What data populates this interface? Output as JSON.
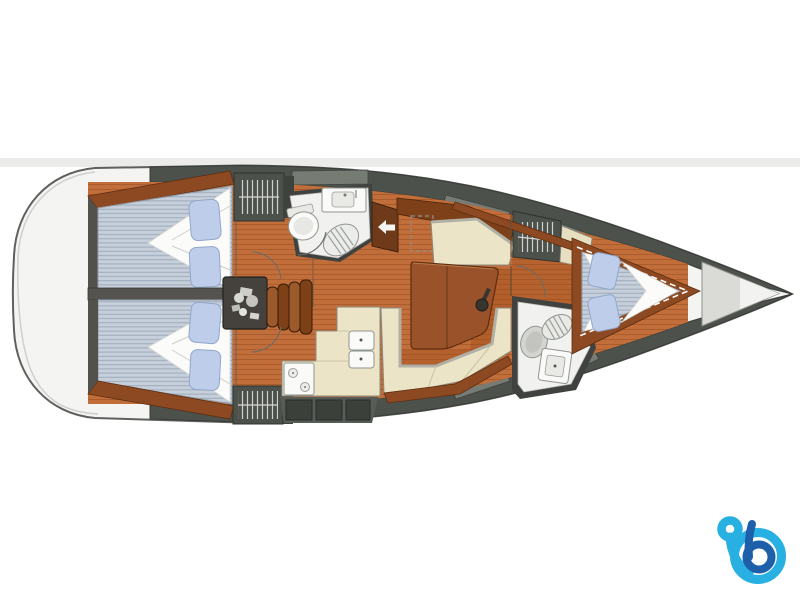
{
  "page": {
    "background": "#ffffff",
    "top_band": "#ebebe9"
  },
  "diagram": {
    "type": "sailboat-interior-floor-plan",
    "orientation": "bow-right-stern-left",
    "areas": [
      "stern-transom",
      "aft-cabin-port",
      "aft-cabin-starboard",
      "hanging-locker-port",
      "hanging-locker-starboard",
      "engine-compartment",
      "companionway-steps",
      "aft-head-toilet-sink-shower",
      "chart-table",
      "nav-seat",
      "salon-table",
      "salon-settee",
      "galley-stove",
      "galley-double-sink",
      "forward-head",
      "forward-hanging-locker",
      "forward-cabin-vberth",
      "anchor-locker",
      "bow-tip"
    ]
  },
  "colors": {
    "page_bg": "#ffffff",
    "band": "#ebebe9",
    "hull": "#f4f4f2",
    "hull_stroke": "#5f5f5d",
    "deck": "#4c514b",
    "deck_panel": "#767b74",
    "floor": "#c26e3a",
    "wood": "#8d4a22",
    "wood_dark": "#5d2d10",
    "table": "#99522a",
    "cream": "#ece4c6",
    "cream_edge": "#8a8a80",
    "mattress": "#c7d0da",
    "mattress_edge": "#93a0ae",
    "pillow": "#bdcdea",
    "pillow_edge": "#91a7cb",
    "blanket": "#fbfbf9",
    "wall": "#3f423e",
    "fixture": "#f1f1ef",
    "fixture_stroke": "#8f958f",
    "locker": "#45423d",
    "logo_light": "#29b0e3",
    "logo_dark": "#1d5fa9"
  },
  "logo": {
    "name": "b-brand-logo",
    "light_blue": "#29b0e3",
    "dark_blue": "#1d5fa9"
  }
}
